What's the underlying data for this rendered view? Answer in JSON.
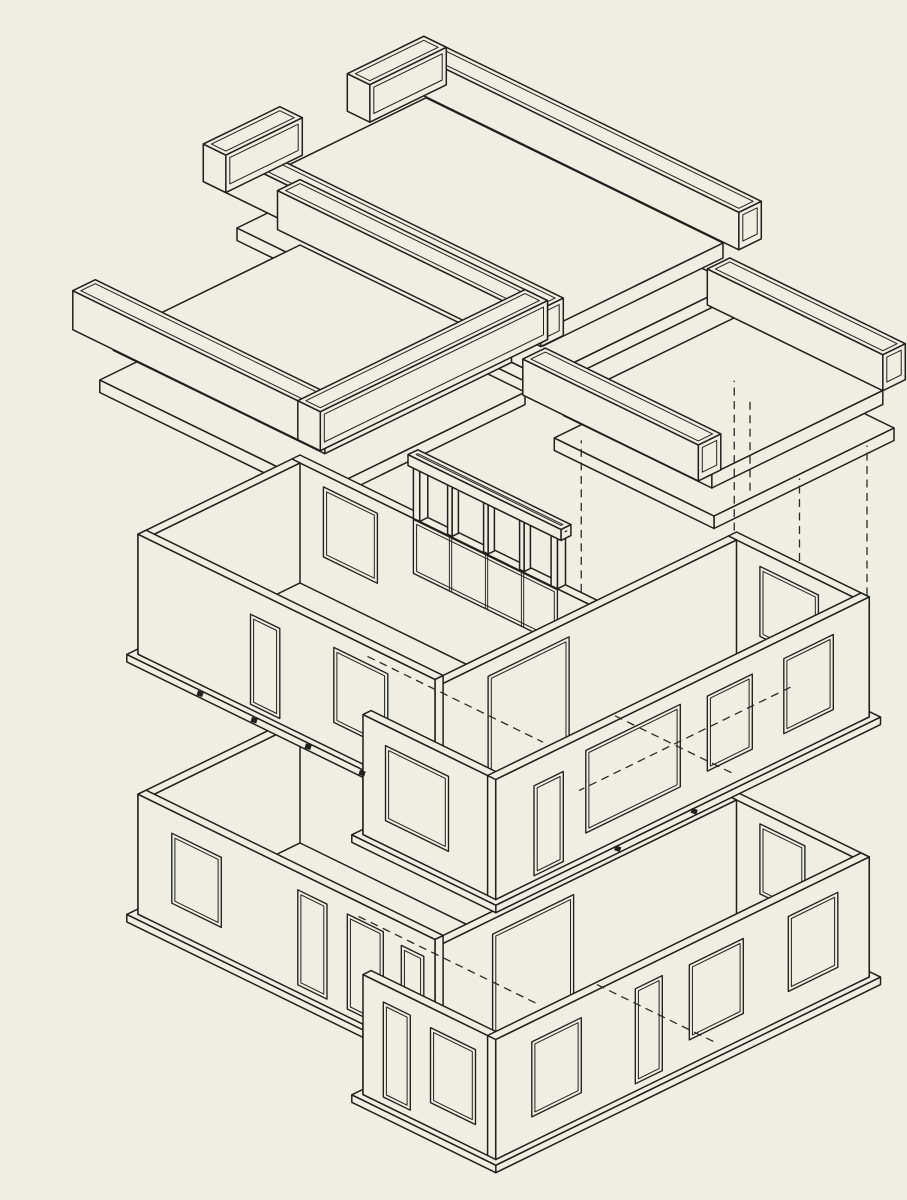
{
  "meta": {
    "description": "Exploded axonometric line drawing of a two-storey L-plan building: three roof slab assemblies with channel parapet beams lifted above, an upper storey of walls with window and door openings, and a ground storey of walls below, linked by dashed projection lines",
    "drawing_type": "exploded-axonometric",
    "figure_title": ""
  },
  "canvas": {
    "width": 907,
    "height": 1200
  },
  "colors": {
    "paper": "#f0ede3",
    "ink": "#20201c",
    "ink_soft": "#2b2b26"
  },
  "iso": {
    "ox": 300,
    "oy": 835,
    "u": 45,
    "v": 22,
    "zs": 50,
    "line_w_main": 1.5,
    "line_w_thin": 1.0,
    "line_w_open": 1.35,
    "dash_pattern": "8 5.5",
    "opening_inset": 0.07
  },
  "groups": [
    {
      "name": "roof-assembly-center",
      "prims": [
        {
          "k": "box",
          "x": 2.55,
          "y": -0.3,
          "z": 14.75,
          "dx": 6.8,
          "dy": 4.25,
          "dz": 0.25
        },
        {
          "k": "box",
          "x": 2.6,
          "y": -0.2,
          "z": 15.5,
          "dx": 6.6,
          "dy": 4.0,
          "dz": 0.3
        },
        {
          "k": "box",
          "x": 2.2,
          "y": -0.55,
          "z": 15.95,
          "dx": 7.5,
          "dy": 0.5,
          "dz": 0.75,
          "inset": true
        },
        {
          "k": "box",
          "x": 2.2,
          "y": 3.85,
          "z": 15.95,
          "dx": 7.5,
          "dy": 0.5,
          "dz": 0.75,
          "inset": true
        },
        {
          "k": "box",
          "x": 2.2,
          "y": -0.55,
          "z": 15.95,
          "dx": 0.5,
          "dy": 1.7,
          "dz": 0.75,
          "inset": true
        },
        {
          "k": "box",
          "x": 2.2,
          "y": 2.65,
          "z": 15.95,
          "dx": 0.5,
          "dy": 1.7,
          "dz": 0.75,
          "inset": true
        }
      ]
    },
    {
      "name": "roof-assembly-left",
      "prims": [
        {
          "k": "box",
          "x": -0.35,
          "y": -0.35,
          "z": 10.5,
          "dx": 5.0,
          "dy": 4.45,
          "dz": 0.25
        },
        {
          "k": "box",
          "x": -0.25,
          "y": -0.25,
          "z": 11.3,
          "dx": 4.7,
          "dy": 4.15,
          "dz": 0.28
        },
        {
          "k": "box",
          "x": -0.6,
          "y": -0.6,
          "z": 11.8,
          "dx": 5.5,
          "dy": 0.5,
          "dz": 0.78,
          "inset": true
        },
        {
          "k": "box",
          "x": -0.6,
          "y": 3.95,
          "z": 11.8,
          "dx": 5.5,
          "dy": 0.5,
          "dz": 0.78,
          "inset": true
        },
        {
          "k": "box",
          "x": 4.4,
          "y": -0.6,
          "z": 11.8,
          "dx": 0.5,
          "dy": 5.05,
          "dz": 0.78,
          "inset": true
        }
      ]
    },
    {
      "name": "roof-assembly-right",
      "prims": [
        {
          "k": "box",
          "x": 6.3,
          "y": -3.35,
          "z": 10.75,
          "dx": 3.55,
          "dy": 4.0,
          "dz": 0.25
        },
        {
          "k": "box",
          "x": 6.4,
          "y": -3.25,
          "z": 11.45,
          "dx": 3.3,
          "dy": 3.8,
          "dz": 0.28
        },
        {
          "k": "box",
          "x": 6.0,
          "y": -3.55,
          "z": 11.9,
          "dx": 3.9,
          "dy": 0.5,
          "dz": 0.72,
          "inset": true
        },
        {
          "k": "box",
          "x": 6.0,
          "y": 0.55,
          "z": 11.9,
          "dx": 3.9,
          "dy": 0.5,
          "dz": 0.72,
          "inset": true
        }
      ]
    },
    {
      "name": "projection-dashed-lines",
      "prims": [
        {
          "k": "dash",
          "a": [
            6.6,
            -3.05,
            7.65
          ],
          "b": [
            6.6,
            -3.05,
            10.65
          ]
        },
        {
          "k": "dash",
          "a": [
            9.55,
            -3.05,
            7.65
          ],
          "b": [
            9.55,
            -3.05,
            10.65
          ]
        },
        {
          "k": "dash",
          "a": [
            6.6,
            0.35,
            7.65
          ],
          "b": [
            6.6,
            0.35,
            10.95
          ]
        },
        {
          "k": "dash",
          "a": [
            9.55,
            -1.55,
            7.65
          ],
          "b": [
            9.55,
            -1.55,
            10.65
          ]
        },
        {
          "k": "dash",
          "a": [
            6.95,
            -3.05,
            8.6
          ],
          "b": [
            6.95,
            -3.05,
            10.4
          ]
        }
      ]
    },
    {
      "name": "ground-floor-walls",
      "prims": [
        {
          "k": "box",
          "x": -0.12,
          "y": -0.12,
          "z": -0.15,
          "dx": 6.85,
          "dy": 3.85,
          "dz": 0.15
        },
        {
          "k": "box",
          "x": 6.48,
          "y": -3.22,
          "z": -0.15,
          "dx": 3.2,
          "dy": 8.55,
          "dz": 0.15
        },
        {
          "k": "box",
          "x": 0,
          "y": 0,
          "z": 0,
          "dx": 6.6,
          "dy": 0.18,
          "dz": 2.4
        },
        {
          "k": "opY",
          "wy": 0.18,
          "x1": 1.7,
          "x2": 2.3,
          "z1": 0.8,
          "z2": 2.2,
          "mull": [
            0.5
          ]
        },
        {
          "k": "opY",
          "wy": 0.18,
          "x1": 2.95,
          "x2": 3.55,
          "z1": 0.8,
          "z2": 2.2,
          "mull": [
            0.5
          ]
        },
        {
          "k": "box",
          "x": 6.6,
          "y": -3.1,
          "z": 0,
          "dx": 2.95,
          "dy": 0.18,
          "dz": 2.4
        },
        {
          "k": "opY",
          "wy": -2.92,
          "x1": 7.3,
          "x2": 8.3,
          "z1": 0.75,
          "z2": 2.15
        },
        {
          "k": "box",
          "x": 6.6,
          "y": -2.92,
          "z": 0,
          "dx": 0.18,
          "dy": 8.12,
          "dz": 2.4
        },
        {
          "k": "opX",
          "wx": 6.78,
          "y1": 0.7,
          "y2": 2.5,
          "z1": 0.05,
          "z2": 2.1
        },
        {
          "k": "box",
          "x": 0,
          "y": 0.18,
          "z": 0,
          "dx": 0.18,
          "dy": 3.42,
          "dz": 2.4
        },
        {
          "k": "box",
          "x": 0,
          "y": 3.42,
          "z": 0,
          "dx": 6.6,
          "dy": 0.18,
          "dz": 2.4
        },
        {
          "k": "opY",
          "wy": 3.6,
          "x1": 0.75,
          "x2": 1.85,
          "z1": 0.55,
          "z2": 1.95
        },
        {
          "k": "opY",
          "wy": 3.6,
          "x1": 3.55,
          "x2": 4.2,
          "z1": 0.15,
          "z2": 2.05
        },
        {
          "k": "opY",
          "wy": 3.6,
          "x1": 4.65,
          "x2": 5.45,
          "z1": 0.15,
          "z2": 2.05
        },
        {
          "k": "opY",
          "wy": 3.6,
          "x1": 5.85,
          "x2": 6.35,
          "z1": 0.45,
          "z2": 1.95
        },
        {
          "k": "box",
          "x": 6.6,
          "y": 5.02,
          "z": 0,
          "dx": 2.95,
          "dy": 0.18,
          "dz": 2.4
        },
        {
          "k": "opY",
          "wy": 5.2,
          "x1": 7.05,
          "x2": 7.65,
          "z1": 0.15,
          "z2": 2.05
        },
        {
          "k": "opY",
          "wy": 5.2,
          "x1": 8.1,
          "x2": 9.1,
          "z1": 0.5,
          "z2": 2.0
        },
        {
          "k": "box",
          "x": 9.37,
          "y": -3.1,
          "z": 0,
          "dx": 0.18,
          "dy": 8.3,
          "dz": 2.4
        },
        {
          "k": "opX",
          "wx": 9.55,
          "y1": -2.4,
          "y2": -1.3,
          "z1": 0.5,
          "z2": 2.0
        },
        {
          "k": "opX",
          "wx": 9.55,
          "y1": -0.3,
          "y2": 0.9,
          "z1": 0.5,
          "z2": 2.0
        },
        {
          "k": "opX",
          "wx": 9.55,
          "y1": 1.5,
          "y2": 2.1,
          "z1": 0.15,
          "z2": 2.05
        },
        {
          "k": "opX",
          "wx": 9.55,
          "y1": 3.3,
          "y2": 4.4,
          "z1": 0.5,
          "z2": 2.0
        },
        {
          "k": "dash",
          "a": [
            2.5,
            1.2,
            0
          ],
          "b": [
            6.5,
            1.2,
            0
          ]
        },
        {
          "k": "dash",
          "a": [
            6.7,
            0.1,
            0
          ],
          "b": [
            9.3,
            0.1,
            0
          ]
        }
      ]
    },
    {
      "name": "upper-floor-walls",
      "prims": [
        {
          "k": "box",
          "x": -0.12,
          "y": -0.12,
          "z": 5.05,
          "dx": 6.85,
          "dy": 3.85,
          "dz": 0.15
        },
        {
          "k": "box",
          "x": 6.48,
          "y": -3.22,
          "z": 5.05,
          "dx": 3.2,
          "dy": 8.55,
          "dz": 0.15
        },
        {
          "k": "box",
          "x": 0,
          "y": 0,
          "z": 5.2,
          "dx": 6.6,
          "dy": 0.18,
          "dz": 2.4
        },
        {
          "k": "opY",
          "wy": 0.18,
          "x1": 0.7,
          "x2": 1.9,
          "z1": 5.95,
          "z2": 7.35
        },
        {
          "k": "opY",
          "wy": 0.18,
          "x1": 2.7,
          "x2": 5.9,
          "z1": 6.5,
          "z2": 7.58,
          "mull": [
            0.25,
            0.5,
            0.75
          ]
        },
        {
          "k": "box",
          "x": 2.7,
          "y": 0,
          "z": 7.6,
          "dx": 0.14,
          "dy": 0.18,
          "dz": 1.15
        },
        {
          "k": "box",
          "x": 3.44,
          "y": 0.02,
          "z": 7.6,
          "dx": 0.1,
          "dy": 0.14,
          "dz": 1.05
        },
        {
          "k": "box",
          "x": 4.24,
          "y": 0.02,
          "z": 7.6,
          "dx": 0.1,
          "dy": 0.14,
          "dz": 1.05
        },
        {
          "k": "box",
          "x": 5.04,
          "y": 0.02,
          "z": 7.6,
          "dx": 0.1,
          "dy": 0.14,
          "dz": 1.05
        },
        {
          "k": "box",
          "x": 5.76,
          "y": 0,
          "z": 7.6,
          "dx": 0.14,
          "dy": 0.18,
          "dz": 1.15
        },
        {
          "k": "box",
          "x": 2.6,
          "y": -0.02,
          "z": 8.62,
          "dx": 3.4,
          "dy": 0.22,
          "dz": 0.22,
          "inset": true
        },
        {
          "k": "box",
          "x": 6.6,
          "y": -3.1,
          "z": 5.2,
          "dx": 2.95,
          "dy": 0.18,
          "dz": 2.4
        },
        {
          "k": "opY",
          "wy": -2.92,
          "x1": 7.3,
          "x2": 8.6,
          "z1": 5.9,
          "z2": 7.3
        },
        {
          "k": "box",
          "x": 6.6,
          "y": -2.92,
          "z": 5.2,
          "dx": 0.18,
          "dy": 8.12,
          "dz": 2.4
        },
        {
          "k": "opX",
          "wx": 6.78,
          "y1": 0.8,
          "y2": 2.6,
          "z1": 5.25,
          "z2": 7.3
        },
        {
          "k": "box",
          "x": 0,
          "y": 0.18,
          "z": 5.2,
          "dx": 0.18,
          "dy": 3.42,
          "dz": 2.4
        },
        {
          "k": "box",
          "x": 0,
          "y": 3.42,
          "z": 5.2,
          "dx": 6.6,
          "dy": 0.18,
          "dz": 2.4
        },
        {
          "k": "opY",
          "wy": 3.6,
          "x1": 2.5,
          "x2": 3.15,
          "z1": 5.3,
          "z2": 7.1
        },
        {
          "k": "opY",
          "wy": 3.6,
          "x1": 4.35,
          "x2": 5.55,
          "z1": 5.75,
          "z2": 7.25
        },
        {
          "k": "box",
          "x": 6.6,
          "y": 5.02,
          "z": 5.2,
          "dx": 2.95,
          "dy": 0.18,
          "dz": 2.4
        },
        {
          "k": "opY",
          "wy": 5.2,
          "x1": 7.1,
          "x2": 8.5,
          "z1": 5.7,
          "z2": 7.2
        },
        {
          "k": "box",
          "x": 9.37,
          "y": -3.1,
          "z": 5.2,
          "dx": 0.18,
          "dy": 8.3,
          "dz": 2.4
        },
        {
          "k": "opX",
          "wx": 9.55,
          "y1": -2.3,
          "y2": -1.2,
          "z1": 5.7,
          "z2": 7.2
        },
        {
          "k": "opX",
          "wx": 9.55,
          "y1": -0.5,
          "y2": 0.5,
          "z1": 5.7,
          "z2": 7.2
        },
        {
          "k": "opX",
          "wx": 9.55,
          "y1": 1.1,
          "y2": 3.2,
          "z1": 5.65,
          "z2": 7.3
        },
        {
          "k": "opX",
          "wx": 9.55,
          "y1": 3.7,
          "y2": 4.35,
          "z1": 5.3,
          "z2": 7.1
        },
        {
          "k": "dash",
          "a": [
            2.6,
            1.1,
            5.2
          ],
          "b": [
            6.5,
            1.1,
            5.2
          ]
        },
        {
          "k": "dash",
          "a": [
            6.7,
            -0.3,
            5.2
          ],
          "b": [
            9.3,
            -0.3,
            5.2
          ]
        },
        {
          "k": "dash",
          "a": [
            8.0,
            -2.9,
            5.2
          ],
          "b": [
            8.0,
            1.8,
            5.2
          ]
        }
      ]
    },
    {
      "name": "connector-clips",
      "prims": [
        {
          "k": "clip",
          "p": [
            1.5,
            3.72,
            5.12
          ]
        },
        {
          "k": "clip",
          "p": [
            2.7,
            3.72,
            5.12
          ]
        },
        {
          "k": "clip",
          "p": [
            3.9,
            3.72,
            5.12
          ]
        },
        {
          "k": "clip",
          "p": [
            5.1,
            3.72,
            5.12
          ]
        },
        {
          "k": "clip",
          "p": [
            9.66,
            2.6,
            5.12
          ]
        },
        {
          "k": "clip",
          "p": [
            9.66,
            0.9,
            5.12
          ]
        }
      ]
    }
  ]
}
